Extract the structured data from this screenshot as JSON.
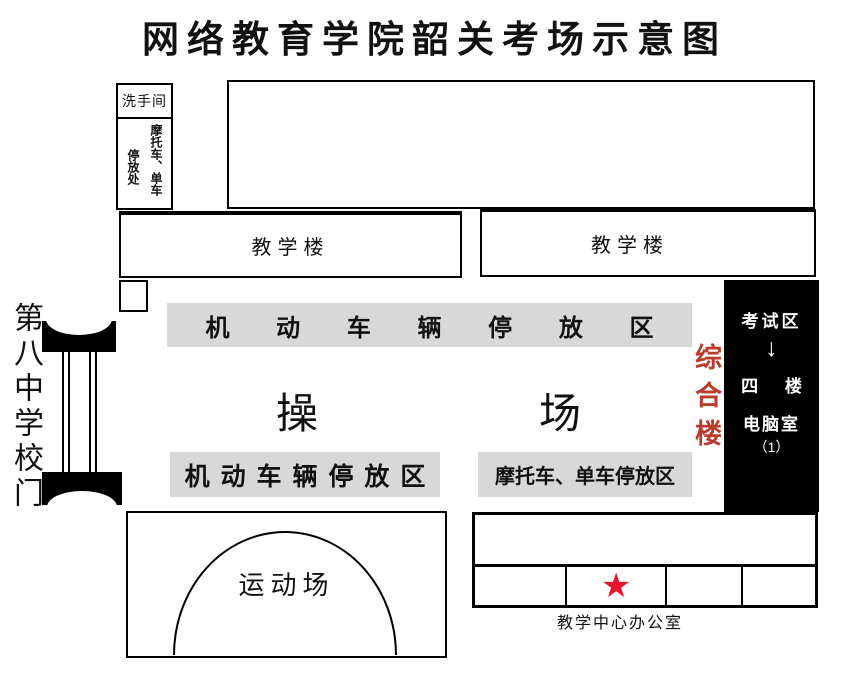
{
  "title": "网络教育学院韶关考场示意图",
  "colors": {
    "parking_bar_gray": "#d8d8d8",
    "complex_label_red": "#b93b2c",
    "star_red": "#e3142b",
    "exam_bar_black": "#000000"
  },
  "top_left": {
    "washroom": "洗手间",
    "bike_parking_col1": "摩托车、单车",
    "bike_parking_col2": "停放处"
  },
  "buildings": {
    "teaching_left": "教学楼",
    "teaching_right": "教学楼",
    "complex_vertical": "综合楼"
  },
  "gate": {
    "label": "第八中学校门"
  },
  "parking": {
    "top_bar": "机 动 车 辆 停 放 区",
    "bottom_left_bar": "机 动 车 辆 停 放 区",
    "bottom_right_bar": "摩托车、单车停放区"
  },
  "playground": {
    "char1": "操",
    "char2": "场"
  },
  "exam_area": {
    "line1": "考试区",
    "arrow": "↓",
    "line2": "四 楼",
    "line3": "电脑室",
    "line4": "（1）"
  },
  "sports_field": {
    "label": "运动场"
  },
  "office": {
    "star": "★",
    "label": "教学中心办公室"
  }
}
